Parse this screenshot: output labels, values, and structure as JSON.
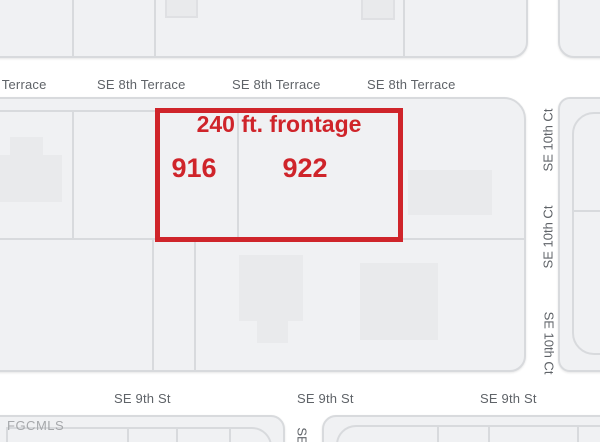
{
  "watermark": "FGCMLS",
  "annotation": {
    "frontage_label": "240 ft. frontage",
    "lot_left": "916",
    "lot_right": "922",
    "outline_color": "#cf242a"
  },
  "streets": {
    "se_8th_terrace": "SE 8th Terrace",
    "se_9th_st": "SE 9th St",
    "se_10th_ct": "SE 10th Ct",
    "se_partial": "SE"
  },
  "colors": {
    "road": "#ffffff",
    "block_fill": "#f0f1f3",
    "parcel_line": "#d8dadd",
    "building_fill": "#e9eaec",
    "street_label": "#5f6368",
    "watermark": "#a6a8ab"
  }
}
